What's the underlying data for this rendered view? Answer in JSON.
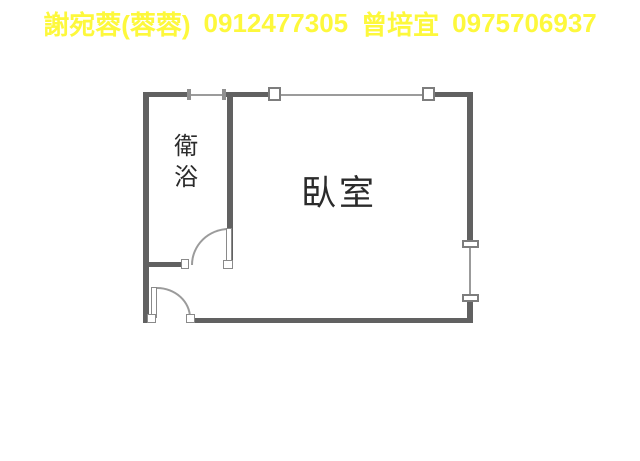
{
  "floorplan": {
    "rooms": [
      {
        "id": "bathroom",
        "label": "衛浴"
      },
      {
        "id": "bedroom",
        "label": "臥室"
      }
    ]
  },
  "caption": {
    "contacts": [
      {
        "name": "謝宛蓉(蓉蓉)",
        "phone": "0912477305"
      },
      {
        "name": "曾培宜",
        "phone": "0975706937"
      }
    ]
  },
  "colors": {
    "background": "#ffffff",
    "wall": "#616161",
    "window_line": "#9b9b9b",
    "fixture_border": "#7d7d7d",
    "label_text": "#2b2b2b",
    "caption_text": "#fdf83c"
  }
}
